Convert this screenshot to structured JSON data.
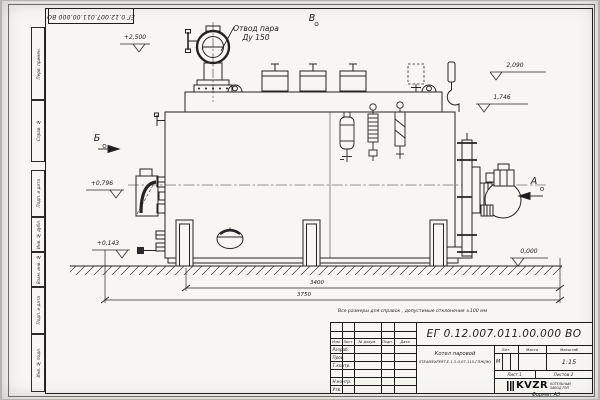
{
  "sheet": {
    "corner_doc_number": "ЕГ 0.12.007.011.00.000 ВО",
    "margin_labels": [
      "Перв. примен.",
      "Справ. №",
      "Подп. и дата",
      "Инв. № дубл.",
      "Взам. инв. №",
      "Подп. и дата",
      "Инв. № подл."
    ],
    "format_label": "Формат А3"
  },
  "drawing": {
    "callout_steam_line1": "Отвод пара",
    "callout_steam_line2": "Ду 150",
    "views": {
      "a": "А",
      "b": "Б",
      "v": "В"
    },
    "elevations": {
      "top": "+2,500",
      "right_upper": "2,090",
      "right_mid": "1,746",
      "left_upper": "+0,796",
      "left_lower": "+0,143",
      "ground": "0,000"
    },
    "dimensions": {
      "inner": "3400",
      "outer": "3750"
    }
  },
  "note": "Все размеры для справок , допустимые отклонения ±100 мм",
  "title_block": {
    "doc_number": "ЕГ 0.12.007.011.00.000  ВО",
    "name_line1": "Котел паровой",
    "name_line2": "STEAMEXPERT-E-1,3-0,07-115-ГЛЖ(Ж)",
    "col_izm": "Изм.",
    "col_list": "Лист",
    "col_doc": "№ докум.",
    "col_podp": "Подп.",
    "col_data": "Дата",
    "row_razrab": "Разраб.",
    "row_prov": "Пров.",
    "row_tkontr": "Т.контр.",
    "row_nkontr": "Н.контр.",
    "row_utv": "Утв.",
    "lit_header": "Лит.",
    "mass_header": "Масса",
    "scale_header": "Масштаб",
    "lit_value": "М",
    "scale_value": "1:15",
    "sheet_label": "Лист  1",
    "sheets_label": "Листов  2",
    "logo_text": "KVZR",
    "logo_sub1": "КОТЕЛЬНЫЙ",
    "logo_sub2": "ЗАВОД РЭП"
  }
}
